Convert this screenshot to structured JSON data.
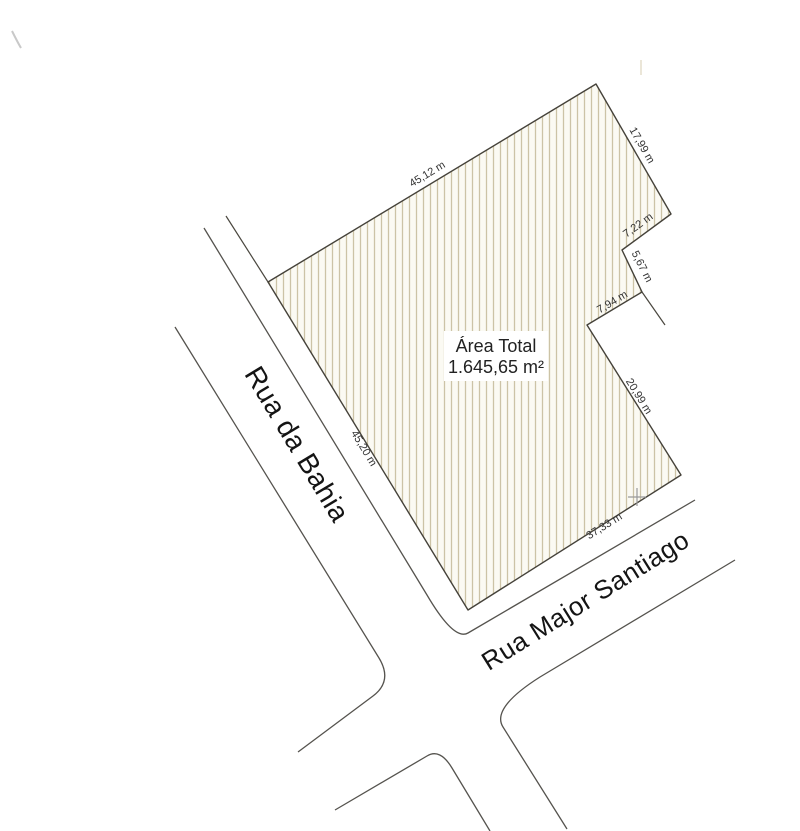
{
  "plot": {
    "area_title": "Área Total",
    "area_value": "1.645,65 m²",
    "dimensions": [
      {
        "side": "northwest-front",
        "label": "45,12 m"
      },
      {
        "side": "northeast",
        "label": "17,99 m"
      },
      {
        "side": "east-notch-top",
        "label": "7,22 m"
      },
      {
        "side": "east-notch-right",
        "label": "5,67 m"
      },
      {
        "side": "east-notch-bottom",
        "label": "7,94 m"
      },
      {
        "side": "southeast",
        "label": "20,99 m"
      },
      {
        "side": "south-street-front",
        "label": "37,33 m"
      },
      {
        "side": "southwest-street-front",
        "label": "45,20 m"
      }
    ]
  },
  "streets": [
    {
      "name": "Rua da Bahia"
    },
    {
      "name": "Rua Major Santiago"
    }
  ],
  "colors": {
    "paper": "#ffffff",
    "plot_fill": "#fbfaf3",
    "hatch_line": "#ccc3a6",
    "plot_outline": "#45423a",
    "street_line": "#55534e",
    "dimension_text": "#333333",
    "street_text": "#141414",
    "survey_cross": "#9a9a9a"
  }
}
